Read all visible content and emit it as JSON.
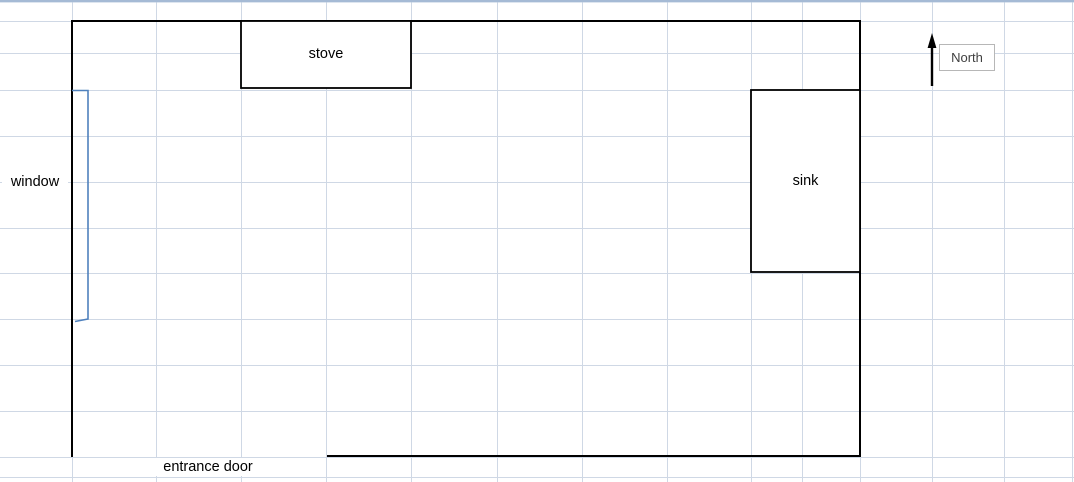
{
  "diagram": {
    "type": "floor-plan",
    "labels": {
      "stove": "stove",
      "sink": "sink",
      "window": "window",
      "entrance_door": "entrance door",
      "north": "North"
    }
  },
  "colors": {
    "bg": "#ffffff",
    "grid": "#cfd8e5",
    "top_edge": "#a5bad5",
    "wall": "#000000",
    "window_blue": "#4f81bd",
    "north_border": "#b7b7b7",
    "north_text": "#404040",
    "label_text": "#000000"
  }
}
